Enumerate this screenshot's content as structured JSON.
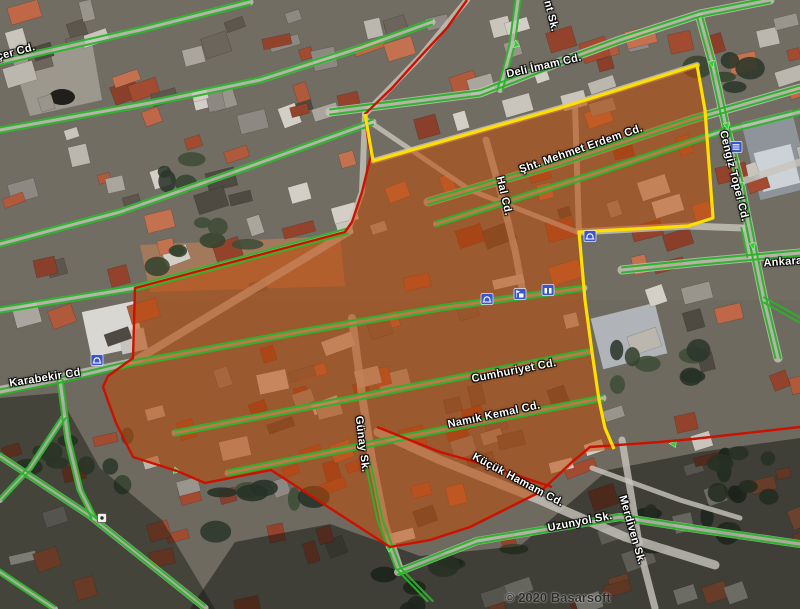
{
  "map": {
    "attribution": "© 2020 Basarsoft",
    "colors": {
      "road_green": "#27b427",
      "arrow_green": "#2fd12f",
      "boundary_red": "#cc1100",
      "boundary_yellow": "#ffdf00",
      "zone_orange": "rgba(191,74,7,0.55)",
      "poi_blue": "#3b55cc",
      "label_text": "#ffffff"
    },
    "labels": [
      {
        "text": "çer Cd.",
        "x": 16,
        "y": 52,
        "rot": -15
      },
      {
        "text": "Deli İmam Cd.",
        "x": 544,
        "y": 66,
        "rot": -13
      },
      {
        "text": "nt Sk.",
        "x": 551,
        "y": 16,
        "rot": 76
      },
      {
        "text": "Şht. Mehmet Erdem Cd.",
        "x": 581,
        "y": 149,
        "rot": -19
      },
      {
        "text": "Hal Cd.",
        "x": 504,
        "y": 196,
        "rot": 77
      },
      {
        "text": "Cengiz Topel Cd.",
        "x": 734,
        "y": 176,
        "rot": 76
      },
      {
        "text": "Ankara",
        "x": 783,
        "y": 262,
        "rot": -4
      },
      {
        "text": "Karabekir Cd",
        "x": 45,
        "y": 378,
        "rot": -9
      },
      {
        "text": "Cumhuriyet Cd.",
        "x": 514,
        "y": 371,
        "rot": -11
      },
      {
        "text": "Namık Kemal Cd.",
        "x": 494,
        "y": 415,
        "rot": -12
      },
      {
        "text": "Günay Sk.",
        "x": 362,
        "y": 444,
        "rot": 83
      },
      {
        "text": "Küçük Hamam Cd.",
        "x": 518,
        "y": 480,
        "rot": 28
      },
      {
        "text": "Uzunyol Sk.",
        "x": 580,
        "y": 522,
        "rot": -11
      },
      {
        "text": "Merdiven Sk.",
        "x": 632,
        "y": 530,
        "rot": 74
      }
    ],
    "pois": [
      {
        "type": "mosque-icon",
        "x": 97,
        "y": 360
      },
      {
        "type": "mosque-icon",
        "x": 487,
        "y": 299
      },
      {
        "type": "flag-building-icon",
        "x": 520,
        "y": 294
      },
      {
        "type": "building-icon",
        "x": 548,
        "y": 290
      },
      {
        "type": "mosque-icon",
        "x": 590,
        "y": 236
      },
      {
        "type": "bank-icon",
        "x": 736,
        "y": 147
      },
      {
        "type": "marker-dot-icon",
        "x": 102,
        "y": 518
      }
    ],
    "arrows": [
      {
        "x": 177,
        "y": 471,
        "rot": 105
      },
      {
        "x": 390,
        "y": 548,
        "rot": 60
      },
      {
        "x": 673,
        "y": 444,
        "rot": 278
      },
      {
        "x": 712,
        "y": 64,
        "rot": 168
      },
      {
        "x": 727,
        "y": 126,
        "rot": 168
      },
      {
        "x": 741,
        "y": 186,
        "rot": 168
      },
      {
        "x": 753,
        "y": 246,
        "rot": 168
      },
      {
        "x": 516,
        "y": 44,
        "rot": 350
      }
    ],
    "overlays": {
      "zone_polygon": "365,114 373,161 560,108 697,65 705,110 713,218 688,226 579,232 585,300 592,352 599,400 605,428 614,449 588,452 540,492 470,527 430,540 390,547 271,470 205,483 177,471 133,457 116,423 103,387 108,376 133,358 135,288 345,232 352,222 362,192 371,155 368,140",
      "red_lines": [
        "467,0 447,28 420,57 392,88 365,114 368,140 371,155 362,192 352,222 345,232 135,288 133,358 108,376 103,387 116,423 133,457 177,471 205,483 271,470 390,547 430,540 470,527 540,492 572,462 590,447 660,442 693,439 800,427",
        "377,427 440,452 483,464 552,487"
      ],
      "yellow_lines": [
        "365,114 373,161 560,108 697,65 705,110 713,218 688,226 579,232 585,300 592,352 599,400 605,428 614,449"
      ],
      "green_roads": [
        "0,62 140,30 250,2",
        "0,130 150,103 260,80 360,48 432,22",
        "330,112 480,93 560,62 620,40 700,14 770,0",
        "0,244 120,212 240,170 373,122",
        "0,310 135,288 348,231",
        "0,392 70,378 133,363",
        "428,202 560,163 690,120 800,88",
        "436,224 600,172 720,132 800,112",
        "133,363 300,332 440,308 584,288",
        "175,433 400,389 588,352",
        "228,473 400,438 603,398",
        "622,270 700,262 800,253",
        "398,572 477,541 620,517 690,528 800,544",
        "500,90 512,45 518,0",
        "368,463 380,520 398,568 430,601",
        "700,18 712,62 725,122 740,182 752,242 764,300 778,358",
        "60,380 68,440 80,490 94,518",
        "63,418 30,468 0,500",
        "0,456 90,516 205,608",
        "0,572 55,609",
        "744,228 750,257",
        "764,300 800,320"
      ]
    }
  }
}
